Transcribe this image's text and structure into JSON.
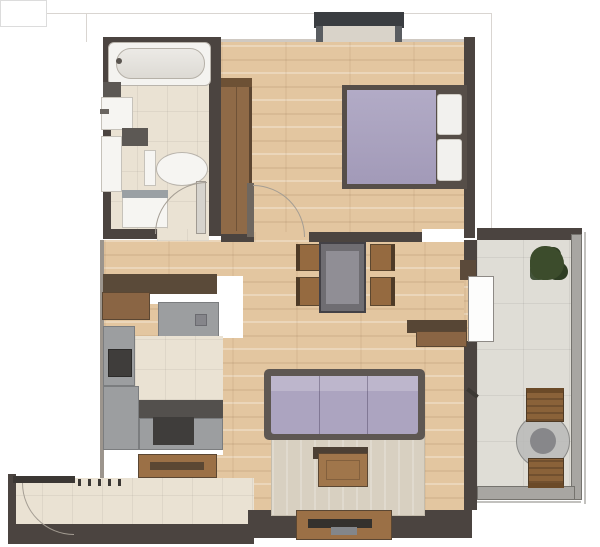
{
  "palette": {
    "wall": "#4b4440",
    "wood_furn": "#9b7046",
    "wood_furn_dark": "#5b4733",
    "counter": "#9c9ea0",
    "counter_dark": "#53504d",
    "appliance": "#3f3d3b",
    "lavender": "#aca4c0",
    "lavender_light": "#bdb6cc",
    "white_fix": "#f6f5f2",
    "rug": "#d8d0c1",
    "plant": "#3c4c2c",
    "arc": "#a49d93",
    "rail": "#a8a6a2",
    "wood_floor": "#e3c6a0",
    "tile_floor": "#eae2d3",
    "balcony_floor": "#dfddd6"
  },
  "plan": {
    "rooms": [
      "bathroom",
      "bedroom",
      "living-dining",
      "kitchen",
      "entry-hall",
      "balcony"
    ],
    "bathroom": {
      "fixtures": [
        "bathtub",
        "wash-basin",
        "toilet",
        "washing-machine",
        "tall-cabinet",
        "wall-blocks",
        "door-swing"
      ]
    },
    "bedroom": {
      "furniture": [
        "window",
        "wardrobe",
        "double-bed",
        "pillow",
        "pillow",
        "door-swing"
      ]
    },
    "living_dining": {
      "furniture": [
        "dining-table",
        "dining-chair",
        "dining-chair",
        "dining-chair",
        "dining-chair",
        "sofa",
        "rug",
        "coffee-table",
        "tv-stand",
        "wall-console"
      ]
    },
    "kitchen": {
      "furniture": [
        "bar-counter",
        "sink-counter",
        "oven-column",
        "cooktop-counter",
        "base-counter",
        "sideboard"
      ]
    },
    "entry_hall": {
      "furniture": [
        "entrance-door",
        "door-swing",
        "coat-hooks"
      ]
    },
    "balcony": {
      "furniture": [
        "potted-plant",
        "round-table",
        "patio-chair",
        "patio-chair",
        "railing",
        "balcony-door"
      ]
    }
  }
}
